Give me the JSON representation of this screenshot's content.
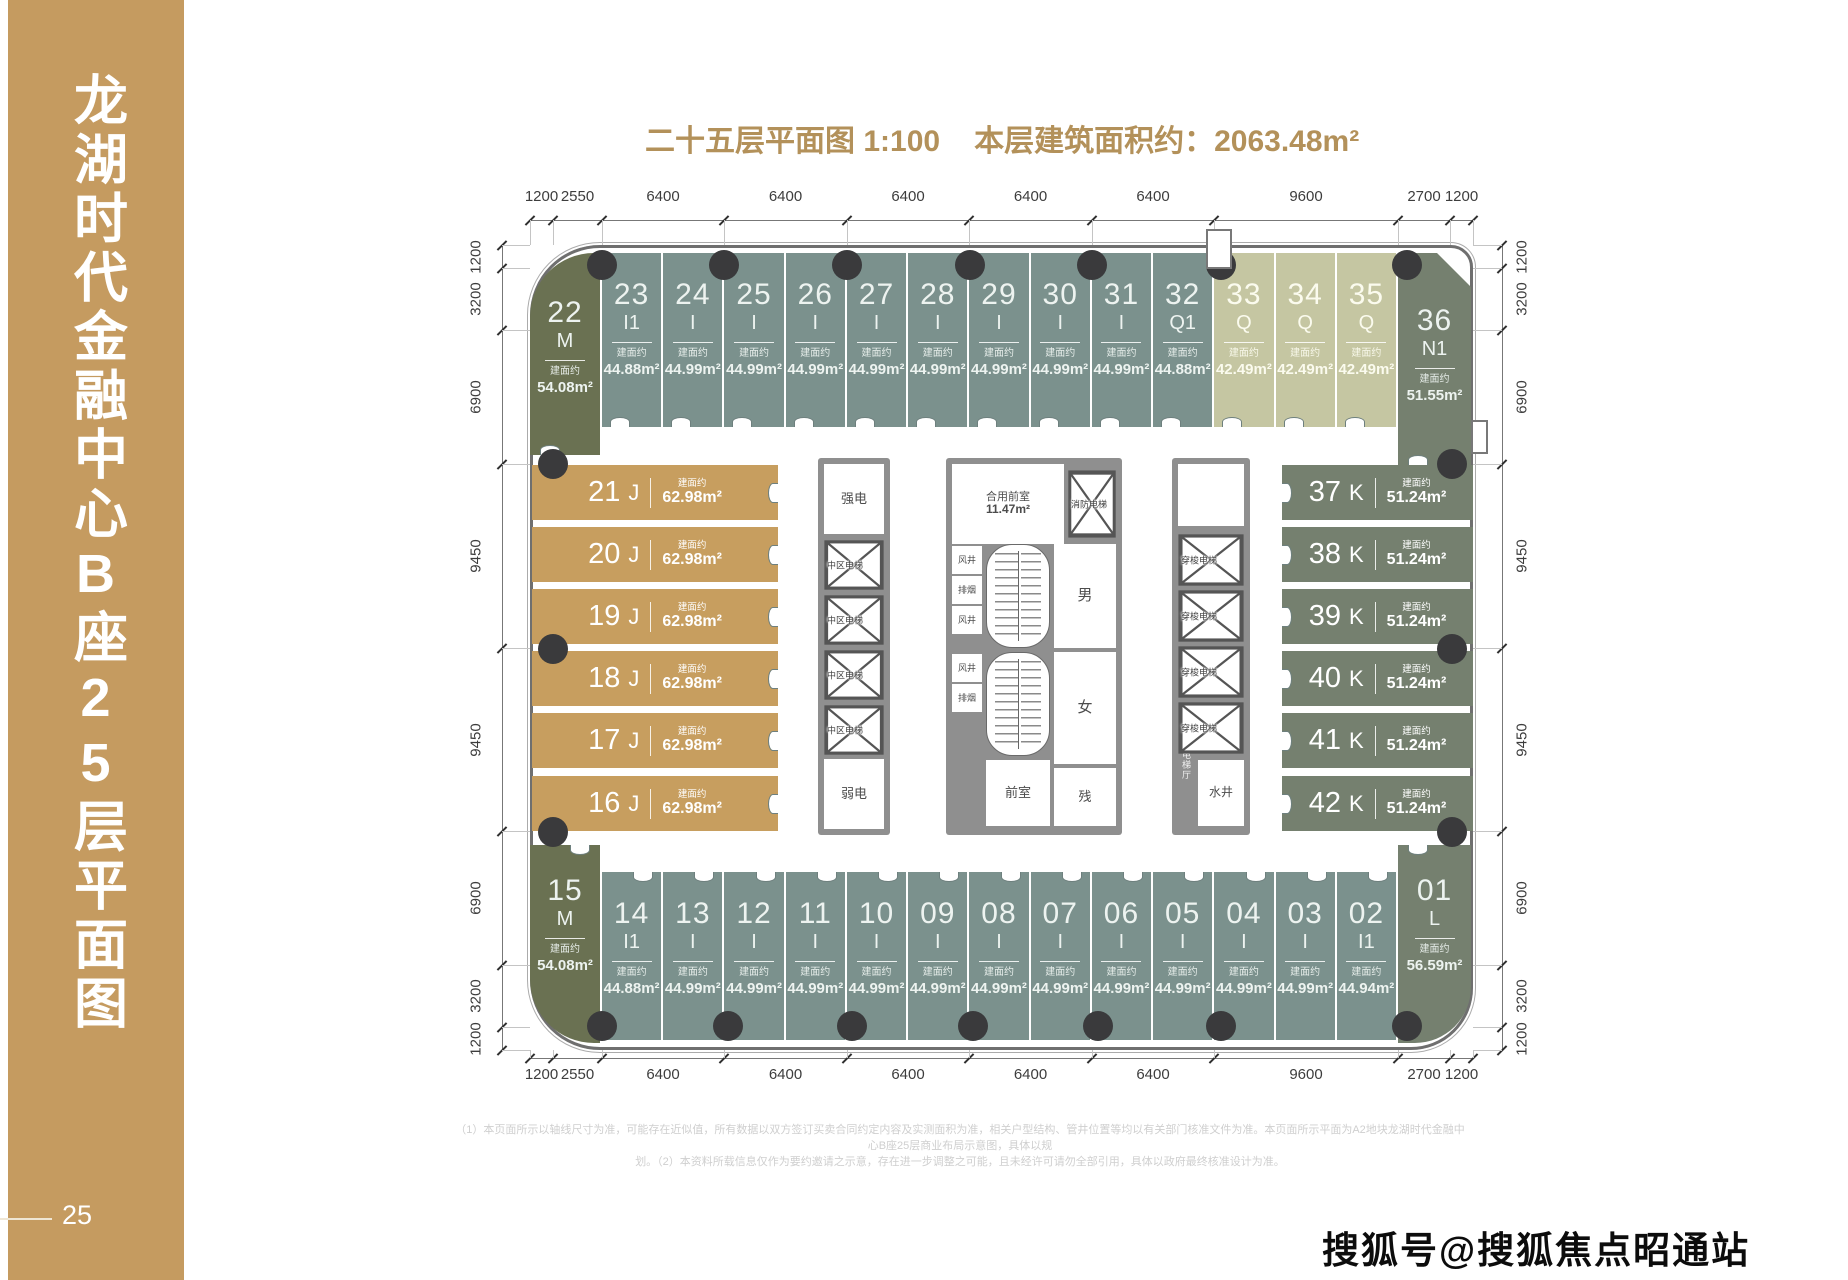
{
  "sidebar": {
    "title": "龙湖时代金融中心B座25层平面图",
    "page_number": "25"
  },
  "header": {
    "plan_title": "二十五层平面图 1:100",
    "area_title": "本层建筑面积约：2063.48m²"
  },
  "watermark": "搜狐号@搜狐焦点昭通站",
  "footnote": {
    "line1": "（1）本页面所示以轴线尺寸为准，可能存在近似值，所有数据以双方签订买卖合同约定内容及实测面积为准，相关户型结构、管井位置等均以有关部门核准文件为准。本页面所示平面为A2地块龙湖时代金融中心B座25层商业布局示意图，具体以规",
    "line2": "划。（2）本资料所载信息仅作为要约邀请之示意，存在进一步调整之可能，且未经许可请勿全部引用，具体以政府最终核准设计为准。"
  },
  "colors": {
    "sidebar_gold": "#c59b60",
    "title_gold": "#b3915a",
    "unit_teal": "#7b918d",
    "unit_olive": "#6a7152",
    "unit_sage": "#c5c6a2",
    "unit_dark": "#75806f",
    "unit_gold": "#c79e5f",
    "wall_gray": "#6f6f6f",
    "core_wall": "#8f8f8f",
    "column_dot": "#3a3a3c"
  },
  "plan": {
    "area_prefix": "建面约",
    "top_row": [
      {
        "no": "22",
        "type": "M",
        "area": "54.08m²",
        "c": "olive"
      },
      {
        "no": "23",
        "type": "I1",
        "area": "44.88m²",
        "c": "teal"
      },
      {
        "no": "24",
        "type": "I",
        "area": "44.99m²",
        "c": "teal"
      },
      {
        "no": "25",
        "type": "I",
        "area": "44.99m²",
        "c": "teal"
      },
      {
        "no": "26",
        "type": "I",
        "area": "44.99m²",
        "c": "teal"
      },
      {
        "no": "27",
        "type": "I",
        "area": "44.99m²",
        "c": "teal"
      },
      {
        "no": "28",
        "type": "I",
        "area": "44.99m²",
        "c": "teal"
      },
      {
        "no": "29",
        "type": "I",
        "area": "44.99m²",
        "c": "teal"
      },
      {
        "no": "30",
        "type": "I",
        "area": "44.99m²",
        "c": "teal"
      },
      {
        "no": "31",
        "type": "I",
        "area": "44.99m²",
        "c": "teal"
      },
      {
        "no": "32",
        "type": "Q1",
        "area": "44.88m²",
        "c": "teal"
      },
      {
        "no": "33",
        "type": "Q",
        "area": "42.49m²",
        "c": "sage"
      },
      {
        "no": "34",
        "type": "Q",
        "area": "42.49m²",
        "c": "sage"
      },
      {
        "no": "35",
        "type": "Q",
        "area": "42.49m²",
        "c": "sage"
      },
      {
        "no": "36",
        "type": "N1",
        "area": "51.55m²",
        "c": "dark"
      }
    ],
    "bottom_row": [
      {
        "no": "15",
        "type": "M",
        "area": "54.08m²",
        "c": "olive"
      },
      {
        "no": "14",
        "type": "I1",
        "area": "44.88m²",
        "c": "teal"
      },
      {
        "no": "13",
        "type": "I",
        "area": "44.99m²",
        "c": "teal"
      },
      {
        "no": "12",
        "type": "I",
        "area": "44.99m²",
        "c": "teal"
      },
      {
        "no": "11",
        "type": "I",
        "area": "44.99m²",
        "c": "teal"
      },
      {
        "no": "10",
        "type": "I",
        "area": "44.99m²",
        "c": "teal"
      },
      {
        "no": "09",
        "type": "I",
        "area": "44.99m²",
        "c": "teal"
      },
      {
        "no": "08",
        "type": "I",
        "area": "44.99m²",
        "c": "teal"
      },
      {
        "no": "07",
        "type": "I",
        "area": "44.99m²",
        "c": "teal"
      },
      {
        "no": "06",
        "type": "I",
        "area": "44.99m²",
        "c": "teal"
      },
      {
        "no": "05",
        "type": "I",
        "area": "44.99m²",
        "c": "teal"
      },
      {
        "no": "04",
        "type": "I",
        "area": "44.99m²",
        "c": "teal"
      },
      {
        "no": "03",
        "type": "I",
        "area": "44.99m²",
        "c": "teal"
      },
      {
        "no": "02",
        "type": "I1",
        "area": "44.94m²",
        "c": "teal"
      },
      {
        "no": "01",
        "type": "L",
        "area": "56.59m²",
        "c": "dark"
      }
    ],
    "left_column": [
      {
        "no": "21",
        "type": "J",
        "area": "62.98m²",
        "c": "gold"
      },
      {
        "no": "20",
        "type": "J",
        "area": "62.98m²",
        "c": "gold"
      },
      {
        "no": "19",
        "type": "J",
        "area": "62.98m²",
        "c": "gold"
      },
      {
        "no": "18",
        "type": "J",
        "area": "62.98m²",
        "c": "gold"
      },
      {
        "no": "17",
        "type": "J",
        "area": "62.98m²",
        "c": "gold"
      },
      {
        "no": "16",
        "type": "J",
        "area": "62.98m²",
        "c": "gold"
      }
    ],
    "right_column": [
      {
        "no": "37",
        "type": "K",
        "area": "51.24m²",
        "c": "dark"
      },
      {
        "no": "38",
        "type": "K",
        "area": "51.24m²",
        "c": "dark"
      },
      {
        "no": "39",
        "type": "K",
        "area": "51.24m²",
        "c": "dark"
      },
      {
        "no": "40",
        "type": "K",
        "area": "51.24m²",
        "c": "dark"
      },
      {
        "no": "41",
        "type": "K",
        "area": "51.24m²",
        "c": "dark"
      },
      {
        "no": "42",
        "type": "K",
        "area": "51.24m²",
        "c": "dark"
      }
    ],
    "core": {
      "strong_power": "强电",
      "weak_power": "弱电",
      "mid_elevator": "中区电梯",
      "shuttle_elevator": "穿梭电梯",
      "fire_elevator": "消防电梯",
      "shared_lobby": "合用前室",
      "shared_lobby_area": "11.47m²",
      "air_shaft": "风井",
      "smoke_vent": "排烟",
      "men": "男",
      "women": "女",
      "vestibule": "前室",
      "accessible": "残",
      "water_shaft": "水井",
      "elevator_hall": "电梯厅"
    },
    "dims": {
      "top": [
        "1200",
        "2550",
        "6400",
        "6400",
        "6400",
        "6400",
        "6400",
        "9600",
        "2700",
        "1200"
      ],
      "bottom": [
        "1200",
        "2550",
        "6400",
        "6400",
        "6400",
        "6400",
        "6400",
        "9600",
        "2700",
        "1200"
      ],
      "left": [
        "1200",
        "3200",
        "6900",
        "9450",
        "9450",
        "6900",
        "3200",
        "1200"
      ],
      "right": [
        "1200",
        "3200",
        "6900",
        "9450",
        "9450",
        "6900",
        "3200",
        "1200"
      ]
    }
  }
}
